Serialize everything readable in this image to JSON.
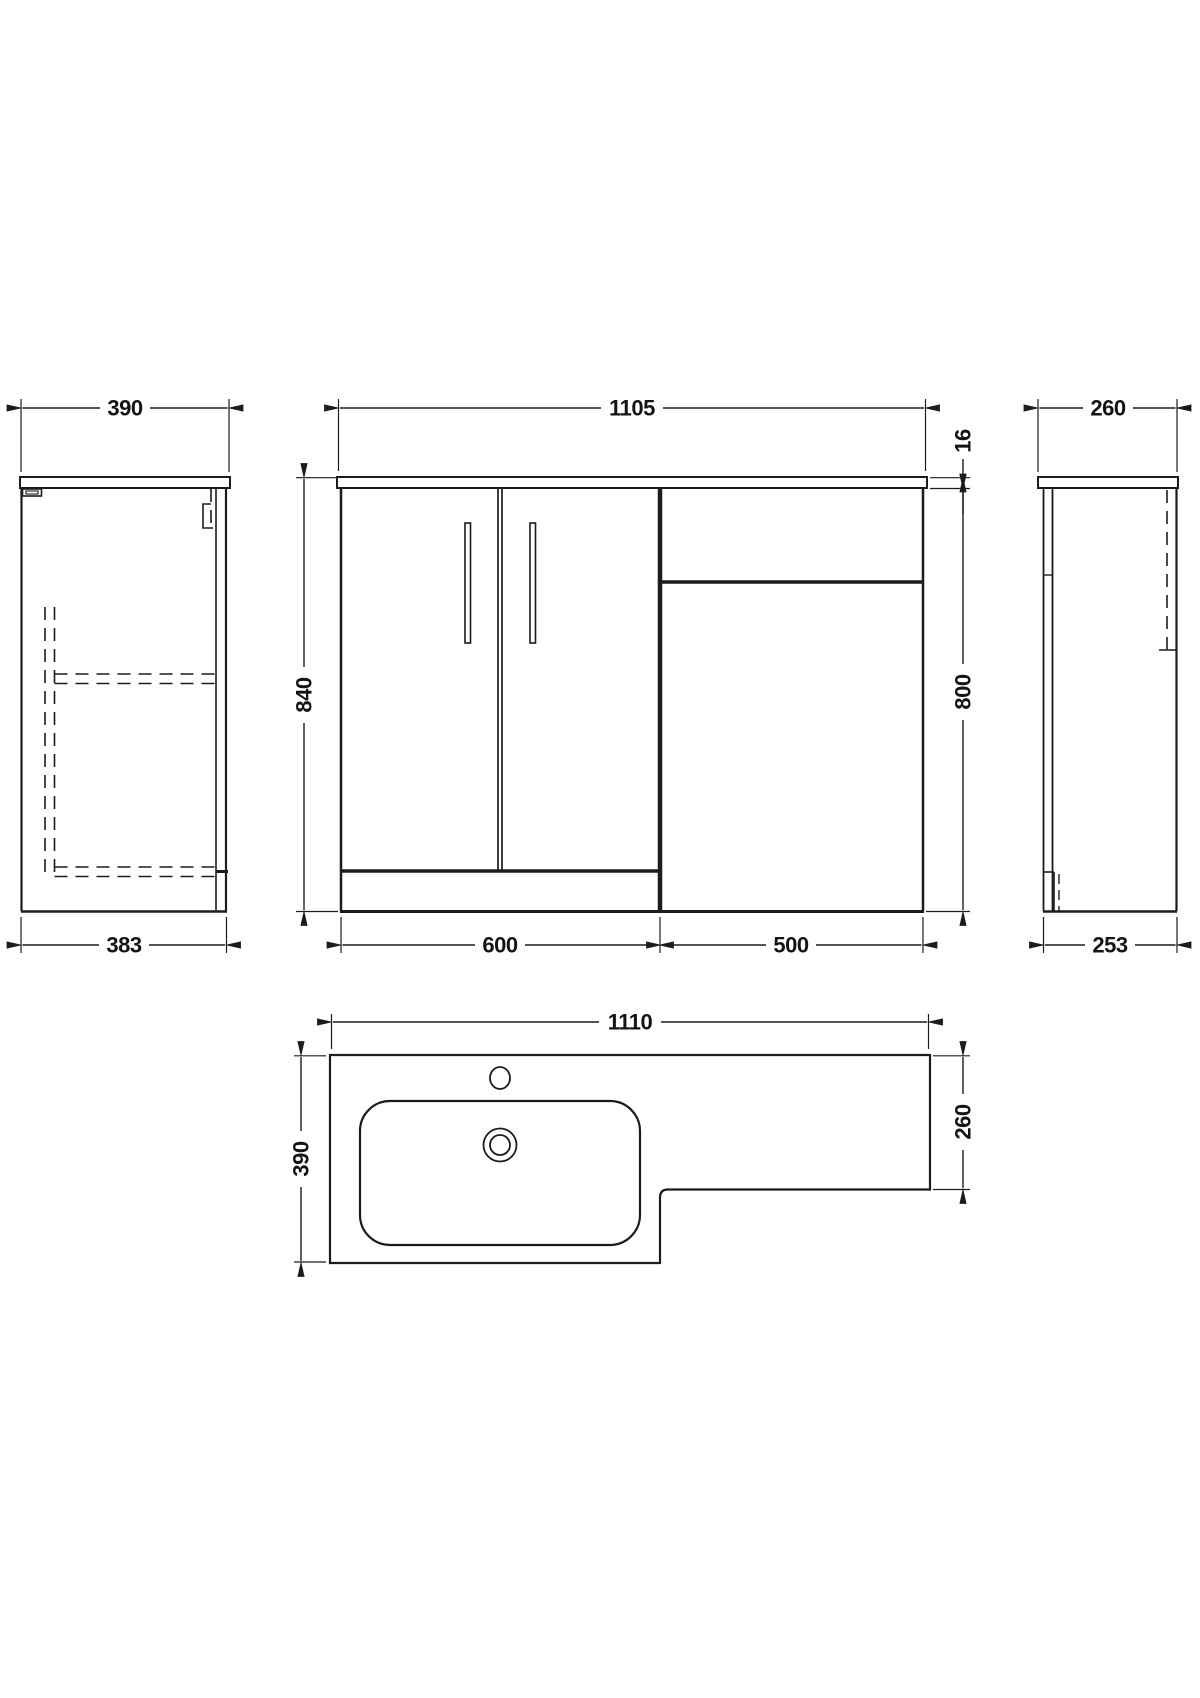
{
  "title": "Bathroom vanity and WC combination unit - dimension drawing",
  "units": "mm",
  "colors": {
    "line": "#1c1c1c",
    "background": "#ffffff"
  },
  "views": {
    "left_side": {
      "dim_worktop_depth": "390",
      "dim_cabinet_depth": "383"
    },
    "front": {
      "dim_overall_width": "1105",
      "dim_overall_height": "840",
      "dim_worktop_thickness": "16",
      "dim_cabinet_height": "800",
      "dim_vanity_width": "600",
      "dim_wc_width": "500"
    },
    "right_side": {
      "dim_worktop_depth": "260",
      "dim_cabinet_depth": "253"
    },
    "plan": {
      "dim_overall_width": "1110",
      "dim_basin_depth": "390",
      "dim_wc_depth": "260"
    }
  }
}
